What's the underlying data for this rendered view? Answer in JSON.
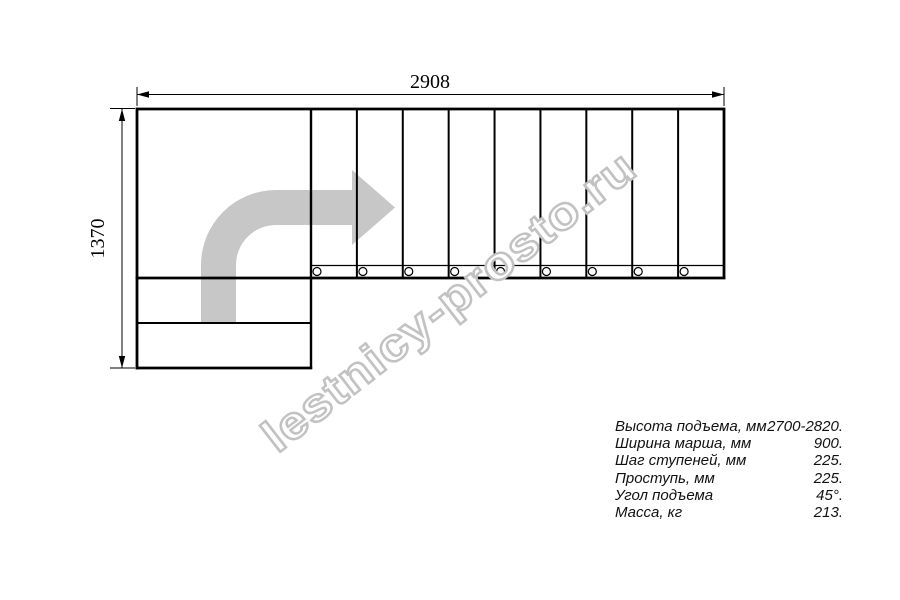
{
  "drawing": {
    "top_dimension": "2908",
    "left_dimension": "1370",
    "watermark": "lestnicy-prosto.ru",
    "steps_count": 9,
    "colors": {
      "line": "#000000",
      "arrow": "#c7c7c7",
      "watermark_fill": "#ffffff",
      "watermark_outline": "#c2c2c2"
    }
  },
  "specs": {
    "rows": [
      {
        "label": "Высота подъема, мм",
        "value": "2700-2820."
      },
      {
        "label": "Ширина марша, мм",
        "value": "900."
      },
      {
        "label": "Шаг ступеней, мм",
        "value": "225."
      },
      {
        "label": "Проступь, мм",
        "value": "225."
      },
      {
        "label": "Угол подъема",
        "value": "45°."
      },
      {
        "label": "Масса, кг",
        "value": "213."
      }
    ]
  }
}
